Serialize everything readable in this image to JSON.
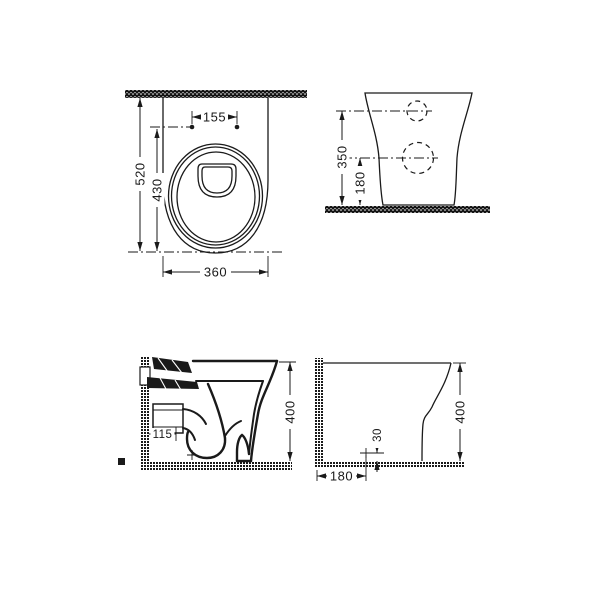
{
  "drawing": {
    "plan_view": {
      "hole_spacing": "155",
      "total_depth": "520",
      "bowl_depth": "430",
      "width": "360"
    },
    "rear_view": {
      "inlet_height": "350",
      "outlet_height": "180"
    },
    "section_view": {
      "outlet_offset": "115",
      "height": "400"
    },
    "profile_view": {
      "height": "400",
      "outlet_above_floor": "30",
      "outlet_from_wall": "180"
    },
    "colors": {
      "line": "#1a1a1a",
      "background": "#ffffff"
    }
  }
}
